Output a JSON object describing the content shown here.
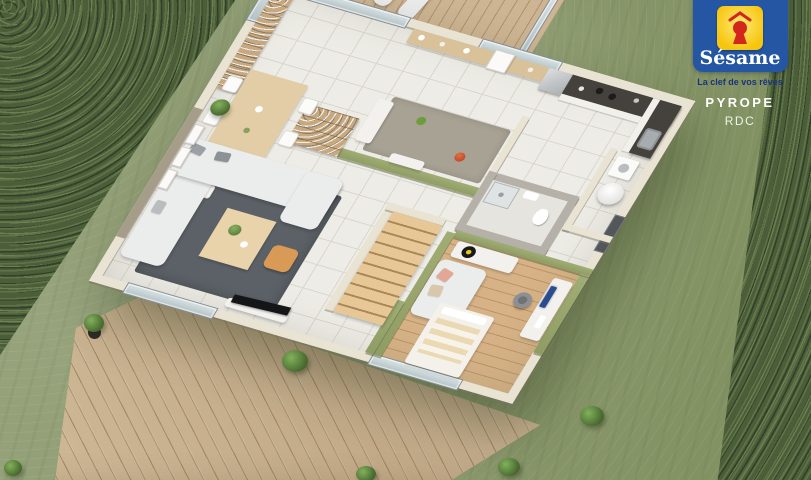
{
  "branding": {
    "partial_top_text": "MAISONS",
    "logo_name": "Sésame",
    "tagline": "La clef de vos rêves",
    "model_name": "PYROPE",
    "floor_label": "RDC"
  },
  "colors": {
    "grass": "#8e9b72",
    "hedge": "#4c5e39",
    "deck": "#c8b192",
    "tile": "#edece6",
    "tile-line": "#d9d6cd",
    "wall": "#e9e3d4",
    "green-wall": "#8f9d64",
    "taupe-wall": "#a59c89",
    "bath-wall": "#b5b1a8",
    "wood-floor": "#d6b286",
    "furniture-wood": "#e2cda6",
    "sofa": "#ebecec",
    "rug": "#5b6166",
    "counter": "#45423e",
    "cabinet": "#f1f0ea",
    "accent-orange": "#d89a55",
    "glass": "#c6d3d6",
    "logo-blue": "#2456a4",
    "logo-yellow": "#f8ca12",
    "logo-red": "#d3271c",
    "tagline-blue": "#17357e"
  },
  "scene": {
    "type": "3d-floor-plan-render",
    "rooms": [
      "terrace",
      "kitchen",
      "dining-area",
      "living-room",
      "utility-room",
      "bathroom",
      "bedroom-office",
      "staircase",
      "entrance"
    ],
    "outdoor": [
      "lawn",
      "hedge",
      "wood-deck",
      "potted-plants"
    ]
  }
}
